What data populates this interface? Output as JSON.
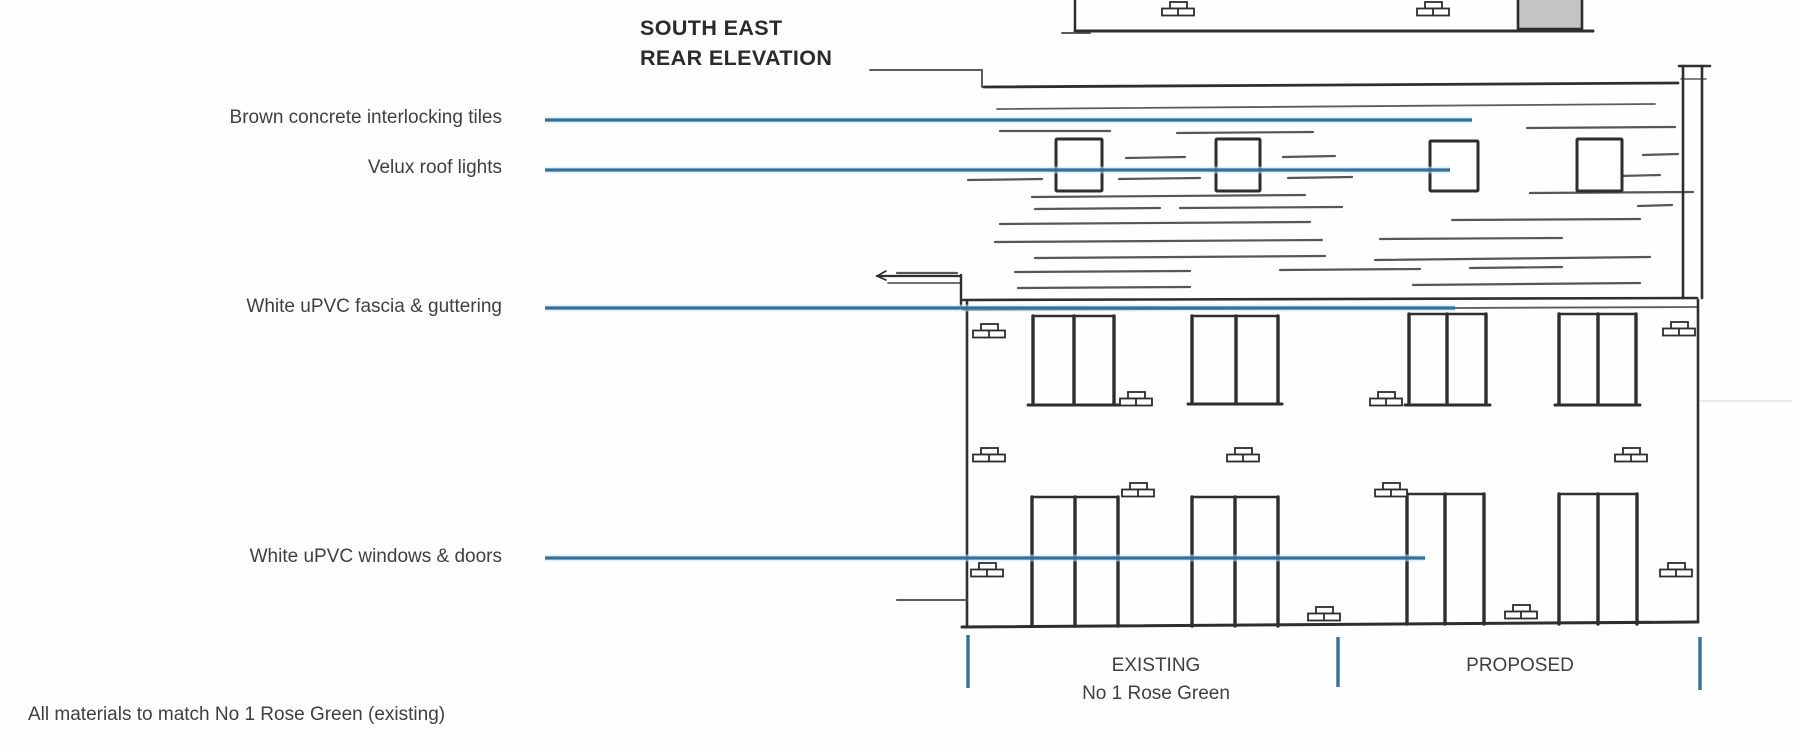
{
  "title": {
    "line1": "SOUTH EAST",
    "line2": "REAR ELEVATION"
  },
  "annotations": [
    {
      "id": "tiles",
      "label": "Brown concrete interlocking tiles"
    },
    {
      "id": "velux",
      "label": "Velux roof lights"
    },
    {
      "id": "fascia",
      "label": "White uPVC fascia & guttering"
    },
    {
      "id": "windows",
      "label": "White uPVC windows & doors"
    }
  ],
  "zones": {
    "existing": {
      "line1": "EXISTING",
      "line2": "No 1 Rose Green"
    },
    "proposed": {
      "label": "PROPOSED"
    }
  },
  "note": "All materials to match No 1 Rose Green (existing)",
  "colors": {
    "leader_blue": "#31719e",
    "ink": "#2e2e2e",
    "chimney_gray": "#c3c5c4",
    "label_text": "#3f3f3f"
  }
}
